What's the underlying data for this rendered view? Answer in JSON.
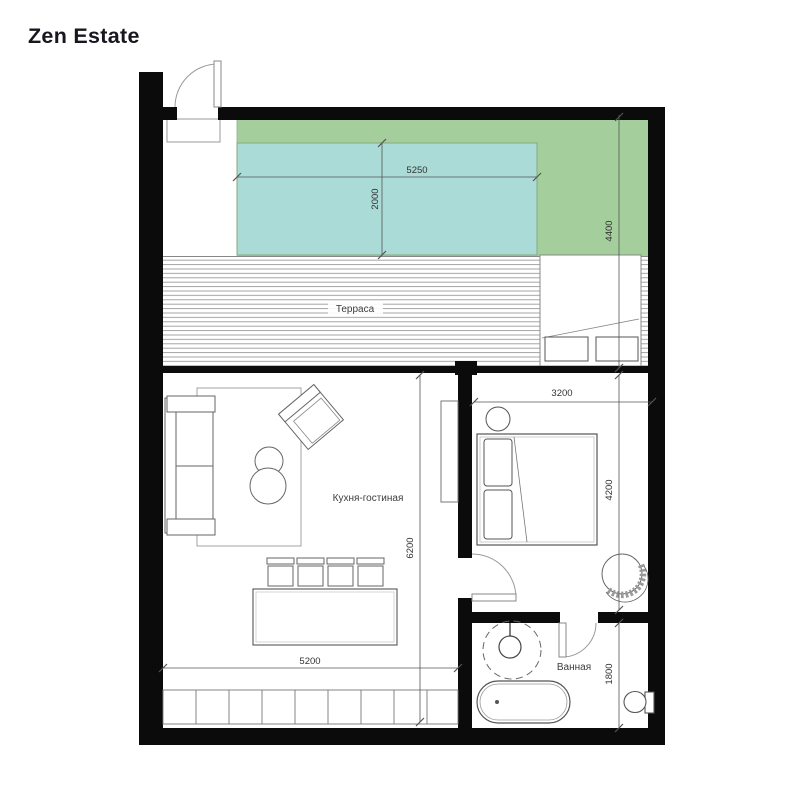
{
  "title": "Zen Estate",
  "floor_plan": {
    "room_labels": {
      "terrace": "Терраса",
      "kitchen_living": "Кухня-гостиная",
      "bathroom": "Ванная"
    },
    "dimensions_mm": {
      "pool_width": "5250",
      "pool_length": "2000",
      "yard_depth": "4400",
      "bedroom_width": "3200",
      "bedroom_length": "4200",
      "bathroom_length": "1800",
      "kitchen_living_width": "5200",
      "kitchen_living_length": "6200"
    },
    "colors": {
      "lawn": "#a4cf9c",
      "pool": "#aadbd6",
      "wall": "#0b0b0b"
    }
  }
}
